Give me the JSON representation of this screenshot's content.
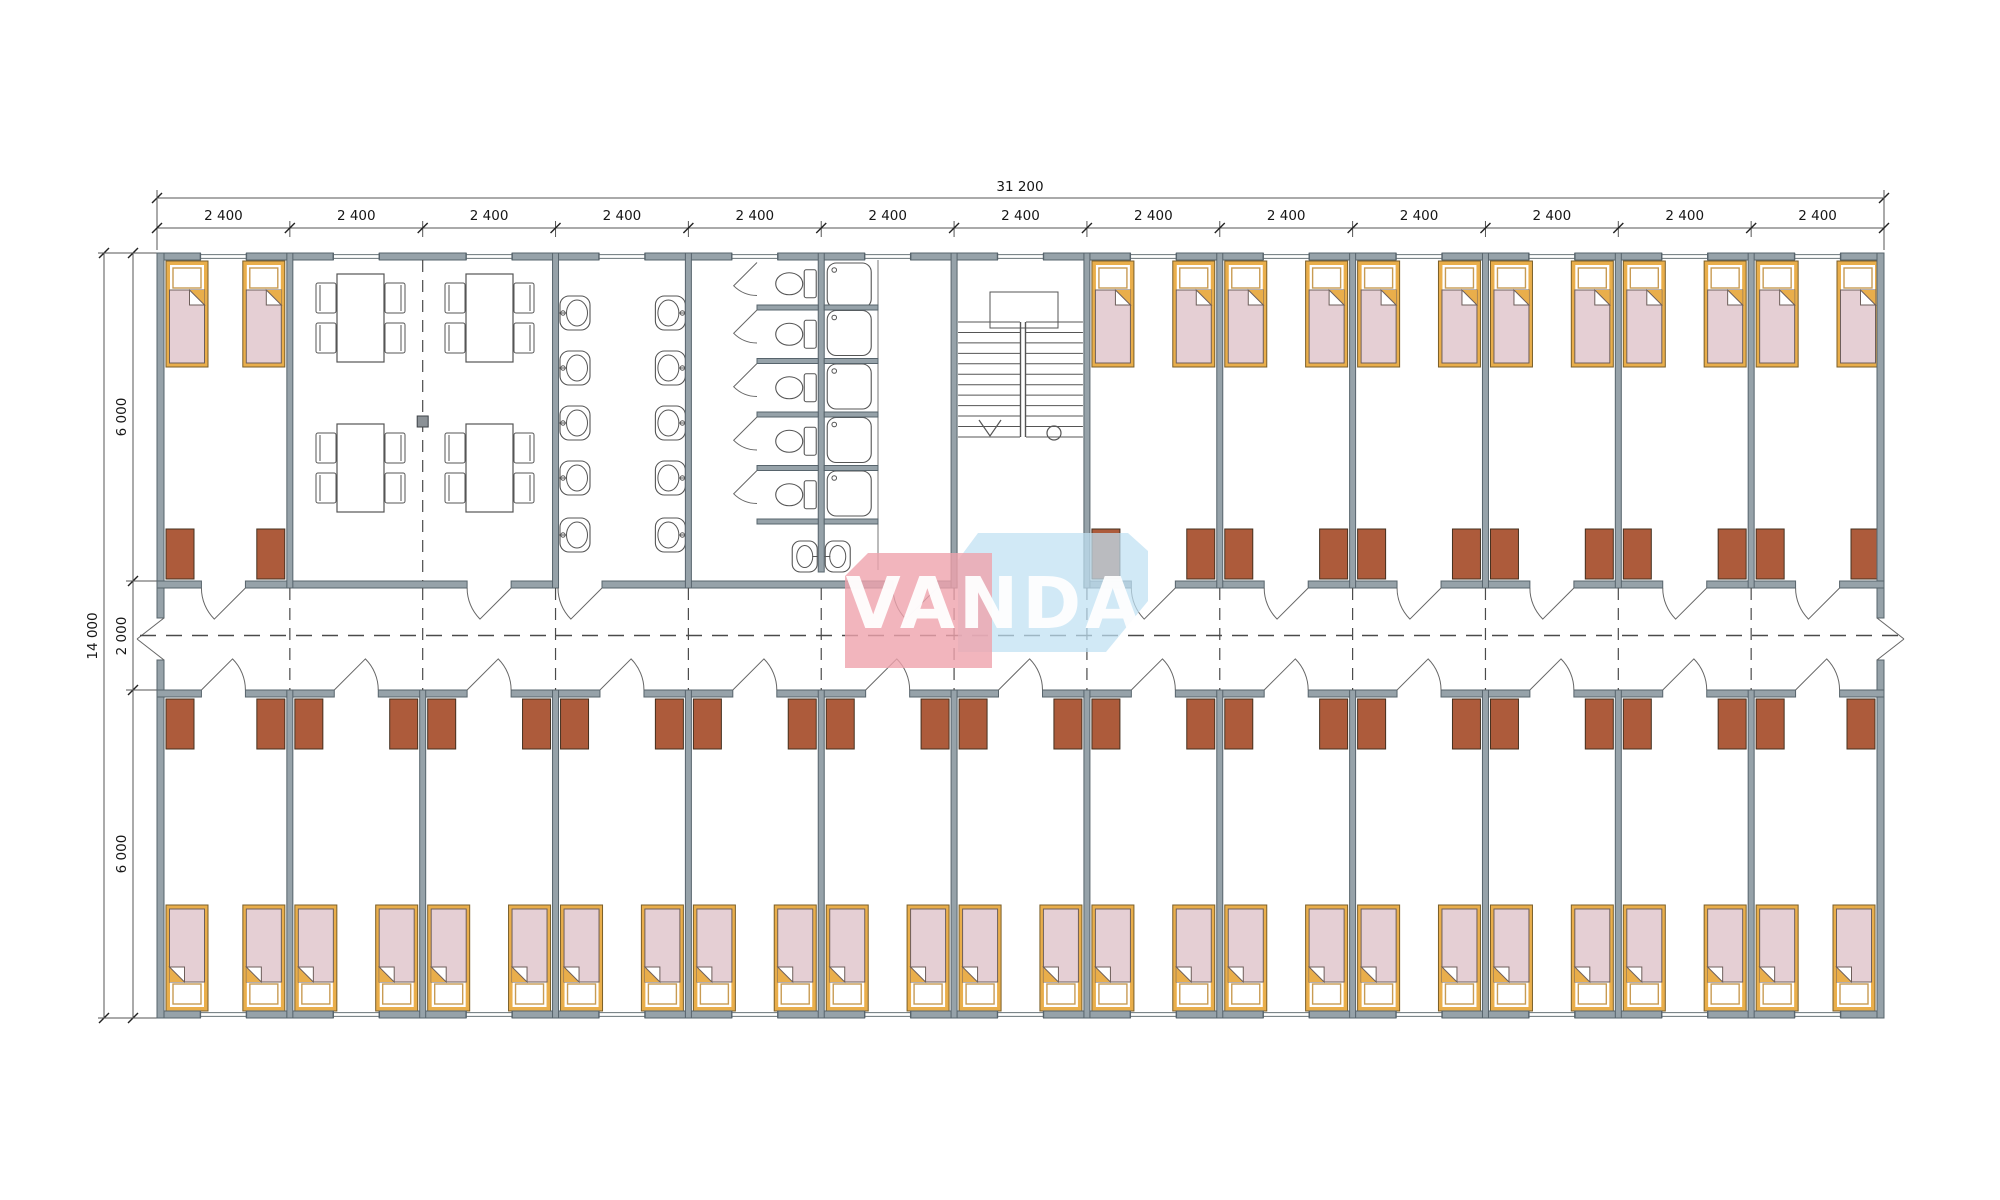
{
  "dimensions": {
    "overall_width": "31 200",
    "overall_height": "14 000",
    "bay_width": "2 400",
    "bay_count": 13,
    "vertical_segments": [
      "6 000",
      "2 000",
      "6 000"
    ]
  },
  "watermark": {
    "text": "VANDA"
  },
  "colors": {
    "wall_fill": "#96A2A9",
    "wall_stroke": "#57646C",
    "bed_frame": "#E9AE4B",
    "bed_frame_stroke": "#7A5E28",
    "blanket": "#E5CFD4",
    "blanket_stroke": "#6E5F5B",
    "pillow_stroke": "#C89B53",
    "cabinet": "#AD5B3B",
    "cabinet_stroke": "#45301F",
    "fixture": "#555555",
    "dash": "#4A4A4A",
    "dim_line": "#555555",
    "marker": "#8B9196",
    "wm_pink": "#EFA3AD",
    "wm_blue": "#BFE0F2"
  },
  "inventory": {
    "bedrooms_top_row": 7,
    "bedrooms_bottom_row": 13,
    "beds": 40,
    "wardrobe_cabinets": 40,
    "dining_tables": 4,
    "chairs_per_table": 4,
    "wash_basins": 10,
    "lobby_basins": 2,
    "toilet_stalls": 5,
    "showers": 5,
    "staircases": 1
  }
}
